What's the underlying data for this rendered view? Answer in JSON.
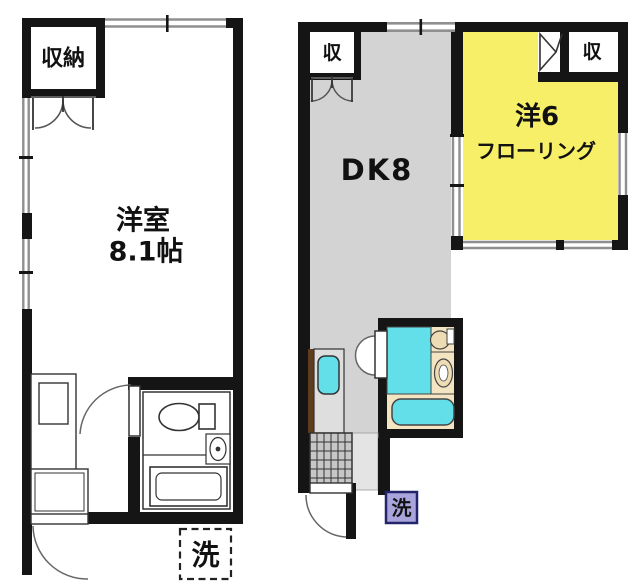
{
  "plan": {
    "type": "apartment-floor-plan",
    "units": 2
  },
  "colors": {
    "wall": "#151515",
    "window_line": "#8f8f8f",
    "dk_floor": "#d3d3d3",
    "room_yellow": "#f6ef67",
    "fixture_cyan": "#62dfe9",
    "bath_beige": "#f3e5c2",
    "fixture_tan": "#eedcb4",
    "tile_gray": "#c7c7c7",
    "step_gray": "#e4e4e4",
    "counter_gray": "#dedede",
    "counter_brown": "#5f3c1d",
    "laundry_purple": "#a9a5dc",
    "laundry_border": "#23246b"
  },
  "left_unit": {
    "closet_label": "収納",
    "room_name": "洋室",
    "room_size": "8.1帖",
    "laundry_label": "洗"
  },
  "right_unit": {
    "closet_a_label": "収",
    "closet_b_label": "収",
    "dk_label": "DK8",
    "room_name": "洋6",
    "room_floor": "フローリング",
    "laundry_label": "洗"
  }
}
